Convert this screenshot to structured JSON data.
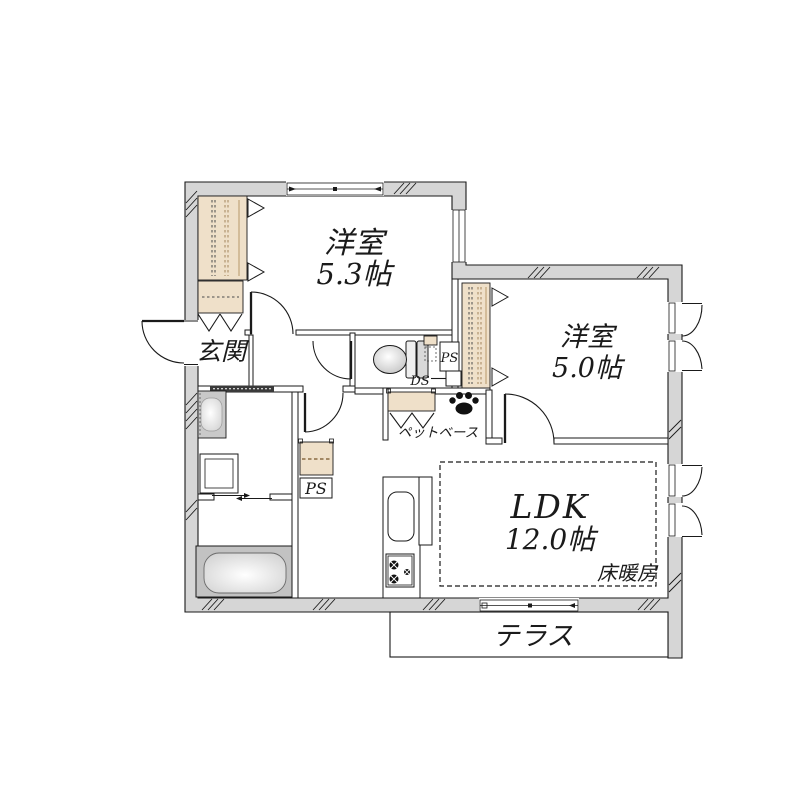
{
  "floor_plan": {
    "rooms": {
      "western_room_1": {
        "label": "洋室",
        "size": "5.3帖"
      },
      "western_room_2": {
        "label": "洋室",
        "size": "5.0帖"
      },
      "ldk": {
        "label": "LDK",
        "size": "12.0帖"
      }
    },
    "labels": {
      "entrance": "玄関",
      "terrace": "テラス",
      "floor_heating": "床暖房",
      "pet_base": "ペットベース",
      "pipe_space_toilet": "PS",
      "duct_space": "DS",
      "pipe_space_hall": "PS"
    },
    "icons": {
      "pet": "paw-print"
    },
    "colors": {
      "wall_fill": "#d6d6d6",
      "closet_fill": "#efe0c9",
      "line": "#1a1a1a",
      "fixture_gray": "#c6c6c6"
    }
  }
}
